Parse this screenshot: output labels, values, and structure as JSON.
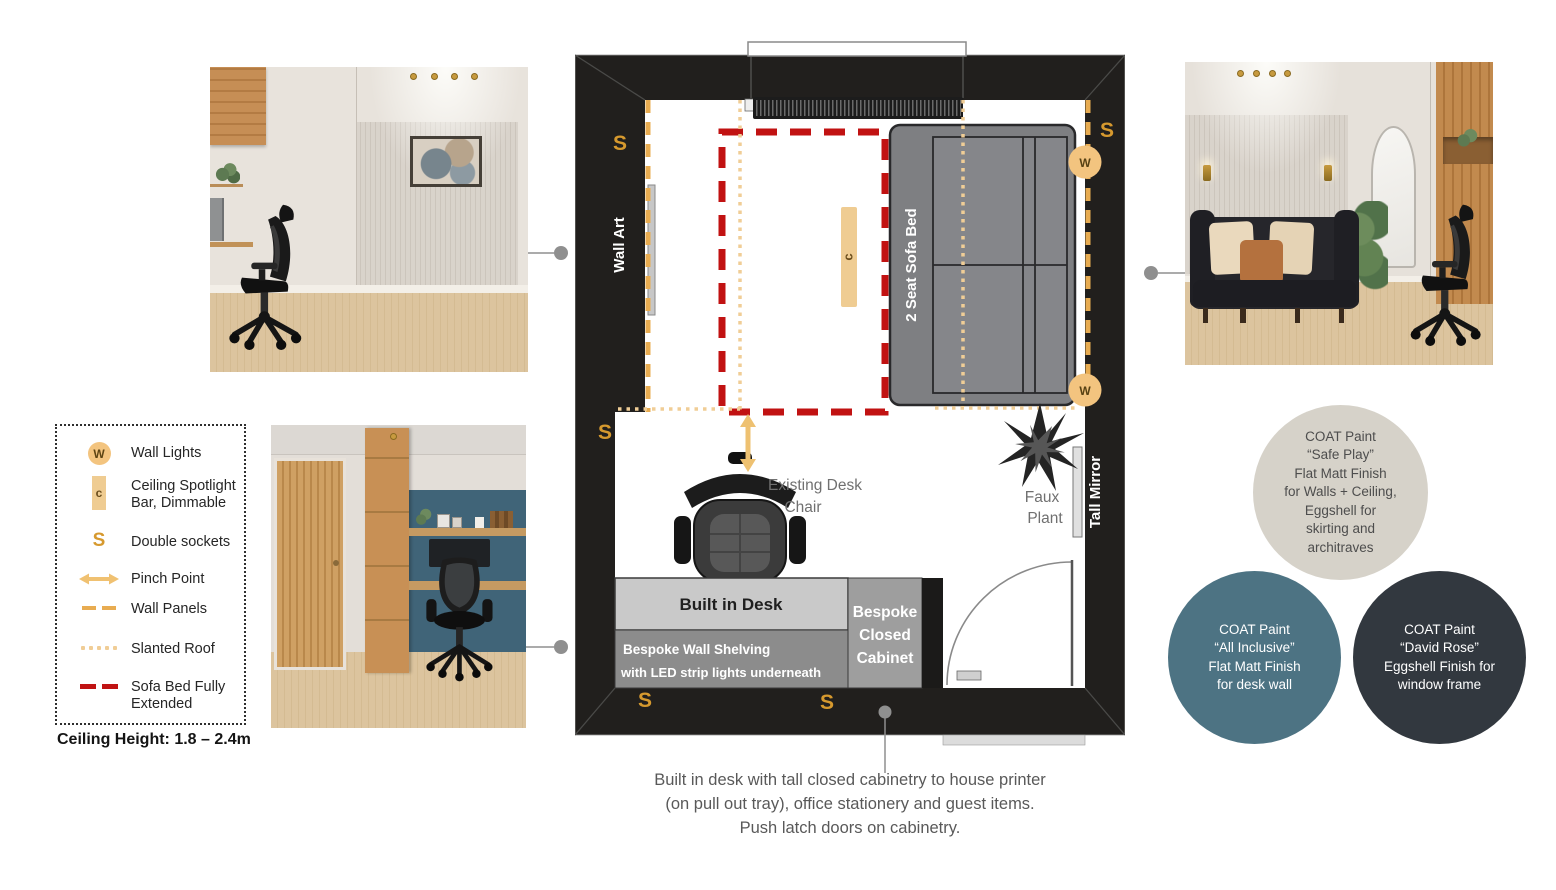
{
  "colors": {
    "accent_gold": "#e8ac51",
    "accent_gold_light": "#f0cd96",
    "symbol_fill": "#f3c47f",
    "sofa_bed_red": "#c01313",
    "wall_black": "#211f1d",
    "teal_paint": "#4d7383",
    "charcoal_paint": "#32383f",
    "neutral_paint": "#d6d2c9"
  },
  "legend": {
    "items": [
      {
        "id": "wall-lights",
        "glyph": "W",
        "label_lines": [
          "Wall Lights"
        ]
      },
      {
        "id": "ceiling-spotlight",
        "glyph": "c",
        "label_lines": [
          "Ceiling Spotlight",
          "Bar, Dimmable"
        ]
      },
      {
        "id": "double-sockets",
        "glyph": "S",
        "label_lines": [
          "Double sockets"
        ]
      },
      {
        "id": "pinch-point",
        "glyph": "",
        "label_lines": [
          "Pinch Point"
        ]
      },
      {
        "id": "wall-panels",
        "glyph": "",
        "label_lines": [
          "Wall Panels"
        ]
      },
      {
        "id": "slanted-roof",
        "glyph": "",
        "label_lines": [
          "Slanted Roof"
        ]
      },
      {
        "id": "sofa-bed-extended",
        "glyph": "",
        "label_lines": [
          "Sofa Bed Fully",
          "Extended"
        ]
      }
    ],
    "ceiling_height": "Ceiling Height: 1.8 – 2.4m"
  },
  "plan": {
    "wall_art": "Wall Art",
    "sofa_bed": "2 Seat Sofa Bed",
    "spotlight_glyph": "c",
    "wall_light_glyph": "W",
    "socket_glyph": "S",
    "desk_chair_label_1": "Existing Desk",
    "desk_chair_label_2": "Chair",
    "faux_plant_1": "Faux",
    "faux_plant_2": "Plant",
    "tall_mirror": "Tall Mirror",
    "built_in_desk": "Built in Desk",
    "shelving_1": "Bespoke Wall Shelving",
    "shelving_2": "with LED strip lights underneath",
    "cabinet_1": "Bespoke",
    "cabinet_2": "Closed",
    "cabinet_3": "Cabinet"
  },
  "paint_swatches": [
    {
      "id": "safe-play",
      "fill": "#d6d2c9",
      "text_color": "#4d4d4d",
      "lines": [
        "COAT Paint",
        "“Safe Play”",
        "Flat Matt Finish",
        "for Walls + Ceiling,",
        "Eggshell for",
        "skirting and",
        "architraves"
      ]
    },
    {
      "id": "all-inclusive",
      "fill": "#4d7383",
      "text_color": "#ffffff",
      "lines": [
        "COAT Paint",
        "“All Inclusive”",
        "Flat Matt Finish",
        "for desk wall"
      ]
    },
    {
      "id": "david-rose",
      "fill": "#32383f",
      "text_color": "#ffffff",
      "lines": [
        "COAT Paint",
        "“David Rose”",
        "Eggshell Finish for",
        "window frame"
      ]
    }
  ],
  "caption": {
    "lines": [
      "Built in desk with tall closed cabinetry to house printer",
      "(on pull out tray), office stationery and guest items.",
      "Push latch doors on cabinetry."
    ]
  }
}
